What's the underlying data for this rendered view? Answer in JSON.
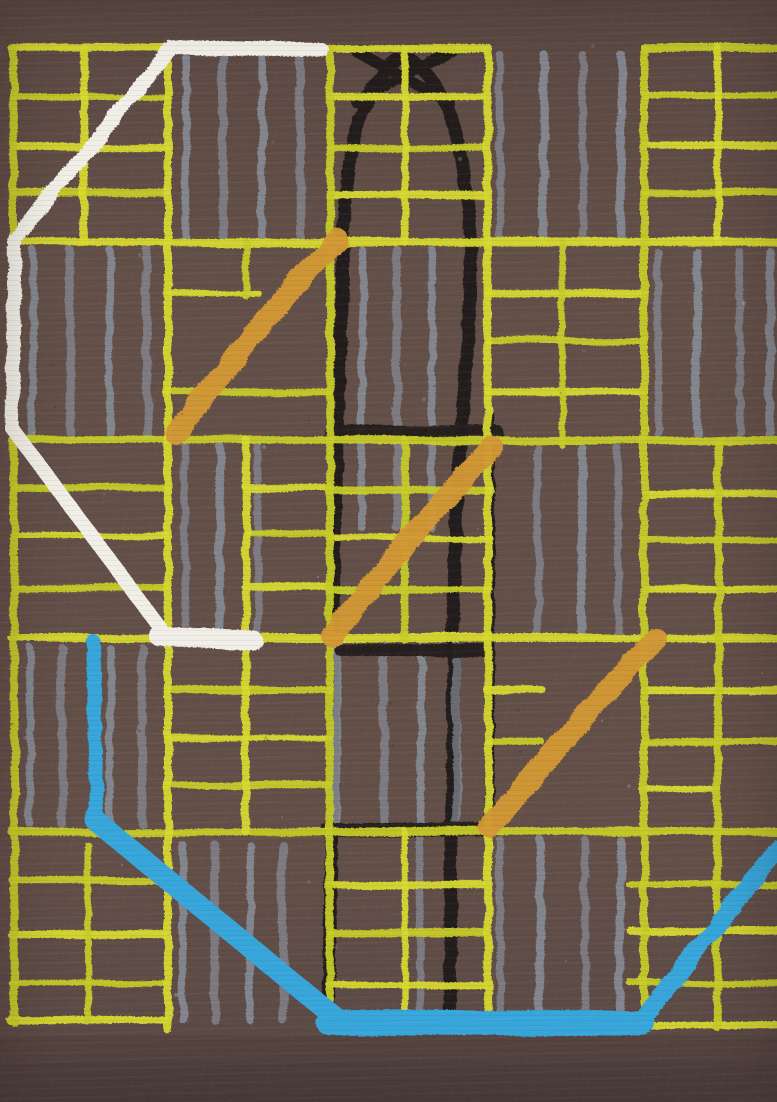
{
  "artwork": {
    "canvas": {
      "width": 777,
      "height": 1102
    },
    "palette": {
      "background": "#5f4b44",
      "background_top": "#57443e",
      "background_bottom": "#554340",
      "yellow": "#d7d92b",
      "yellow_alt": "#c6cb24",
      "gray": "#878d99",
      "black": "#1d1915",
      "orange": "#d2962f",
      "white": "#f2efe8",
      "blue": "#33a4da",
      "speck_light": "#efe9df",
      "speck_dark": "#241a14"
    },
    "layers": {
      "yellow_grid": {
        "h_lines": [
          [
            48,
            12,
            483,
            8
          ],
          [
            48,
            644,
            777,
            8
          ],
          [
            242,
            12,
            777,
            8
          ],
          [
            440,
            12,
            777,
            8
          ],
          [
            638,
            12,
            777,
            8
          ],
          [
            832,
            12,
            777,
            8
          ],
          [
            1020,
            10,
            164,
            8
          ],
          [
            1020,
            327,
            483,
            8
          ],
          [
            1026,
            630,
            777,
            8
          ],
          [
            97,
            14,
            166
          ],
          [
            147,
            14,
            166
          ],
          [
            193,
            14,
            166
          ],
          [
            97,
            330,
            483
          ],
          [
            148,
            330,
            483
          ],
          [
            195,
            330,
            483
          ],
          [
            95,
            644,
            777
          ],
          [
            145,
            644,
            777
          ],
          [
            192,
            644,
            777
          ],
          [
            293,
            170,
            258
          ],
          [
            392,
            170,
            330
          ],
          [
            293,
            488,
            644
          ],
          [
            341,
            488,
            644
          ],
          [
            392,
            488,
            644
          ],
          [
            488,
            14,
            166
          ],
          [
            535,
            14,
            166
          ],
          [
            588,
            14,
            166
          ],
          [
            488,
            246,
            330
          ],
          [
            533,
            246,
            330
          ],
          [
            587,
            246,
            330
          ],
          [
            490,
            330,
            490
          ],
          [
            538,
            330,
            490
          ],
          [
            590,
            330,
            490
          ],
          [
            493,
            644,
            777
          ],
          [
            540,
            644,
            777
          ],
          [
            588,
            644,
            777
          ],
          [
            690,
            170,
            330
          ],
          [
            738,
            170,
            330
          ],
          [
            785,
            170,
            330
          ],
          [
            690,
            488,
            542
          ],
          [
            742,
            488,
            542
          ],
          [
            690,
            644,
            777
          ],
          [
            742,
            644,
            777
          ],
          [
            790,
            644,
            718
          ],
          [
            880,
            12,
            164
          ],
          [
            935,
            12,
            164
          ],
          [
            983,
            12,
            164
          ],
          [
            885,
            330,
            483
          ],
          [
            933,
            330,
            483
          ],
          [
            985,
            330,
            483
          ],
          [
            885,
            630,
            777
          ],
          [
            930,
            630,
            777
          ],
          [
            983,
            630,
            777
          ]
        ],
        "v_lines": [
          [
            14,
            48,
            1022,
            8
          ],
          [
            168,
            48,
            1030,
            8
          ],
          [
            330,
            48,
            1030,
            8
          ],
          [
            488,
            48,
            1030,
            8
          ],
          [
            644,
            48,
            1030,
            8
          ],
          [
            84,
            48,
            242
          ],
          [
            88,
            845,
            1022
          ],
          [
            405,
            48,
            242
          ],
          [
            405,
            440,
            640
          ],
          [
            405,
            832,
            1020
          ],
          [
            246,
            242,
            296
          ],
          [
            246,
            440,
            832
          ],
          [
            562,
            242,
            445
          ],
          [
            718,
            48,
            242
          ],
          [
            718,
            440,
            1028
          ]
        ]
      },
      "gray_stripes": {
        "groups": [
          {
            "xs": [
              186,
              223,
              262,
              300
            ],
            "y1": 58,
            "y2": 238
          },
          {
            "xs": [
              500,
              544,
              583,
              621
            ],
            "y1": 55,
            "y2": 238
          },
          {
            "xs": [
              33,
              70,
              110,
              147
            ],
            "y1": 250,
            "y2": 434
          },
          {
            "xs": [
              658,
              697,
              740,
              770
            ],
            "y1": 252,
            "y2": 434
          },
          {
            "xs": [
              362,
              397,
              432
            ],
            "y1": 250,
            "y2": 528
          },
          {
            "xs": [
              185,
              220,
              258
            ],
            "y1": 446,
            "y2": 634
          },
          {
            "xs": [
              30,
              62,
              110,
              142
            ],
            "y1": 648,
            "y2": 824
          },
          {
            "xs": [
              538,
              582,
              618
            ],
            "y1": 448,
            "y2": 634
          },
          {
            "xs": [
              183,
              215,
              250,
              283
            ],
            "y1": 845,
            "y2": 1020
          },
          {
            "xs": [
              500,
              540,
              585,
              620
            ],
            "y1": 840,
            "y2": 1016
          },
          {
            "xs": [
              337,
              384,
              421,
              456
            ],
            "y1": 645,
            "y2": 826
          },
          {
            "xs": [
              420
            ],
            "y1": 838,
            "y2": 1014
          }
        ]
      },
      "black_structure": {
        "legs": [
          {
            "d": "M397,60 C360,88 346,150 343,250 C339,420 333,520 333,650 C333,800 330,920 328,1018",
            "w": 13
          },
          {
            "d": "M411,60 C452,88 466,150 471,250 C472,350 458,430 456,520 C452,650 452,820 450,1018",
            "w": 13
          },
          {
            "d": "M489,415 C491,550 490,700 489,830",
            "w": 10
          }
        ],
        "cross": [
          {
            "d": "M356,102 L452,50",
            "w": 11
          },
          {
            "d": "M357,52 L450,103",
            "w": 11
          }
        ],
        "bands": [
          [
            433,
            332,
            497,
            15
          ],
          [
            650,
            341,
            486,
            13
          ],
          [
            830,
            327,
            492,
            14
          ],
          [
            833,
            252,
            326,
            7
          ]
        ]
      },
      "orange_strokes": {
        "width": 22,
        "paths": [
          "M338,240 C287,292 229,362 176,434",
          "M492,447 C440,500 383,570 332,636",
          "M656,639 C604,692 545,762 490,827"
        ]
      },
      "white_outline": {
        "main": {
          "d": "M322,50 L172,47 L15,240 L12,428 L161,629",
          "w": 14
        },
        "tail": {
          "d": "M158,636 L254,641",
          "w": 19
        }
      },
      "blue_outline": {
        "segments": [
          {
            "d": "M93,641 L97,824",
            "w": 14
          },
          {
            "d": "M95,820 L337,1019",
            "w": 21
          },
          {
            "d": "M329,1023 L642,1023",
            "w": 25
          },
          {
            "d": "M637,1025 L779,848",
            "w": 18
          }
        ]
      },
      "shade_bands": [
        {
          "y": 1036,
          "h": 66,
          "opacity": 0.08
        },
        {
          "y": 1062,
          "h": 40,
          "opacity": 0.06
        }
      ]
    }
  }
}
